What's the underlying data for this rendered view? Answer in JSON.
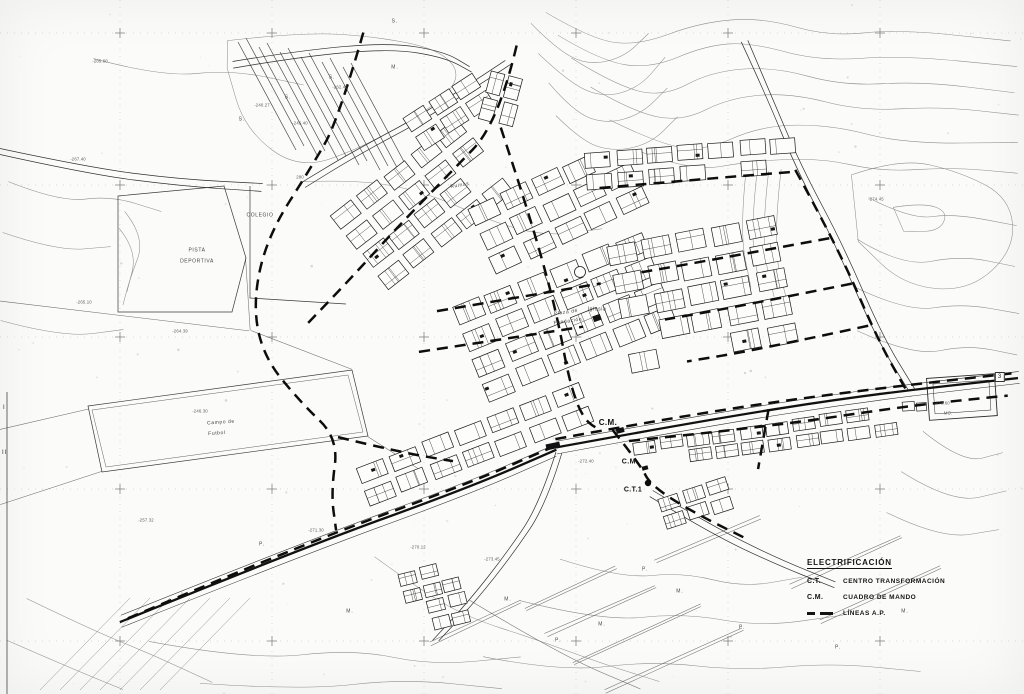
{
  "legend": {
    "title": "ELECTRIFICACIÓN",
    "items": [
      {
        "symbol": "C.T.",
        "label": "CENTRO TRANSFORMACIÓN",
        "is_dash": false
      },
      {
        "symbol": "C.M.",
        "label": "CUADRO DE MANDO",
        "is_dash": false
      },
      {
        "symbol": "",
        "label": "LÍNEAS A.P.",
        "is_dash": true
      }
    ]
  },
  "place_labels": [
    {
      "text": "COLEGIO",
      "x": 260,
      "y": 216,
      "cls": "small-place",
      "rot": 0
    },
    {
      "text": "PISTA",
      "x": 197,
      "y": 251,
      "cls": "small-place",
      "rot": 0
    },
    {
      "text": "DEPORTIVA",
      "x": 197,
      "y": 262,
      "cls": "small-place",
      "rot": 0
    },
    {
      "text": "Campo de",
      "x": 221,
      "y": 423,
      "cls": "small-place",
      "rot": -4
    },
    {
      "text": "Futbol",
      "x": 217,
      "y": 434,
      "cls": "small-place",
      "rot": -4
    },
    {
      "text": "Ruinas",
      "x": 460,
      "y": 186,
      "cls": "small-place",
      "rot": -10
    },
    {
      "text": "Iglesia",
      "x": 597,
      "y": 310,
      "cls": "small-place",
      "rot": 0
    },
    {
      "text": "Plaza de",
      "x": 566,
      "y": 313,
      "cls": "small-place",
      "rot": -8
    },
    {
      "text": "Fundación",
      "x": 568,
      "y": 322,
      "cls": "small-place",
      "rot": -8
    }
  ],
  "equipment_markers": [
    {
      "text": "C.M.",
      "x": 608,
      "y": 423,
      "size": 8
    },
    {
      "text": "C.M.",
      "x": 630,
      "y": 462,
      "size": 7
    },
    {
      "text": "C.T.1",
      "x": 633,
      "y": 490,
      "size": 7
    }
  ],
  "boxed_marker": {
    "text": "3",
    "x": 1000,
    "y": 377
  },
  "edge_ticks": [
    {
      "text": "I",
      "x": 3,
      "y": 405
    },
    {
      "text": "II",
      "x": 2,
      "y": 450
    }
  ],
  "elevation_labels": [
    {
      "text": "280",
      "x": 300,
      "y": 178
    },
    {
      "text": "-285.60",
      "x": 100,
      "y": 62
    },
    {
      "text": "-262.45",
      "x": 340,
      "y": 88
    },
    {
      "text": "-240.27",
      "x": 262,
      "y": 106
    },
    {
      "text": "-245.40",
      "x": 300,
      "y": 124
    },
    {
      "text": "-267.40",
      "x": 78,
      "y": 160
    },
    {
      "text": "-265.10",
      "x": 84,
      "y": 303
    },
    {
      "text": "-264.39",
      "x": 180,
      "y": 332
    },
    {
      "text": "-246.30",
      "x": 200,
      "y": 412
    },
    {
      "text": "-257.32",
      "x": 146,
      "y": 521
    },
    {
      "text": "-271.30",
      "x": 316,
      "y": 531
    },
    {
      "text": "-273.60",
      "x": 942,
      "y": 404
    },
    {
      "text": "MO.",
      "x": 948,
      "y": 414
    },
    {
      "text": "-274.45",
      "x": 876,
      "y": 200
    },
    {
      "text": "-272.40",
      "x": 586,
      "y": 462
    },
    {
      "text": "-273.45",
      "x": 492,
      "y": 560
    },
    {
      "text": "-270.12",
      "x": 418,
      "y": 548
    }
  ],
  "area_letters": [
    {
      "text": "S.",
      "x": 332,
      "y": 78
    },
    {
      "text": "S.",
      "x": 242,
      "y": 120
    },
    {
      "text": "S.",
      "x": 288,
      "y": 98
    },
    {
      "text": "S.",
      "x": 395,
      "y": 22
    },
    {
      "text": "M.",
      "x": 395,
      "y": 68
    },
    {
      "text": "P.",
      "x": 262,
      "y": 545
    },
    {
      "text": "M.",
      "x": 350,
      "y": 612
    },
    {
      "text": "M.",
      "x": 508,
      "y": 600
    },
    {
      "text": "P.",
      "x": 558,
      "y": 641
    },
    {
      "text": "M.",
      "x": 680,
      "y": 592
    },
    {
      "text": "P.",
      "x": 742,
      "y": 628
    },
    {
      "text": "P.",
      "x": 838,
      "y": 648
    },
    {
      "text": "M.",
      "x": 905,
      "y": 612
    },
    {
      "text": "P.",
      "x": 645,
      "y": 570
    },
    {
      "text": "M.",
      "x": 602,
      "y": 625
    }
  ],
  "colors": {
    "ink": "#1a1a1a",
    "faint_line": "#8f8f8f",
    "paper": "#fbfbf9",
    "label": "#3a3a3a"
  }
}
